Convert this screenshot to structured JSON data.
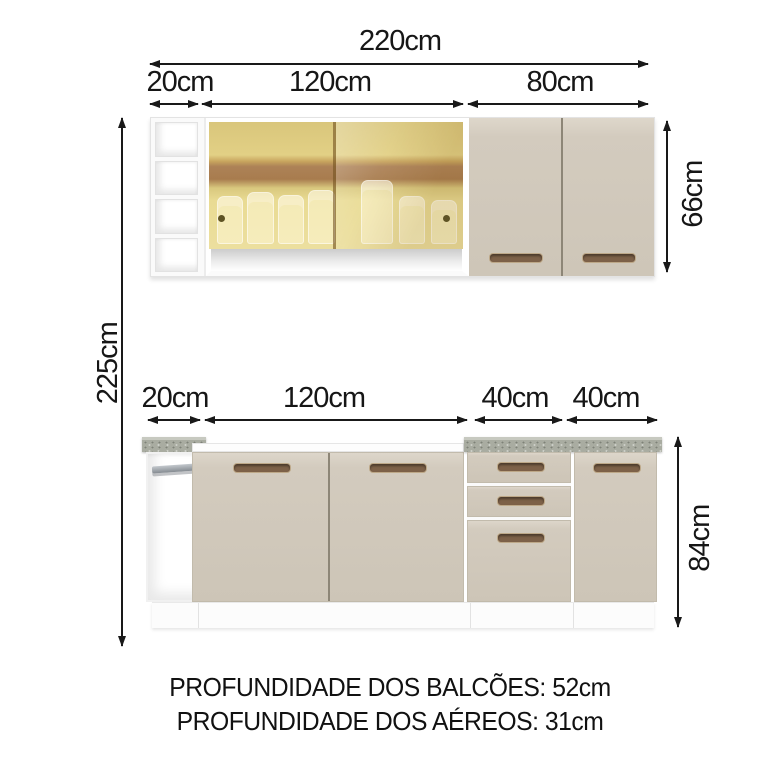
{
  "diagram": {
    "overall": {
      "width": "220cm",
      "height": "225cm"
    },
    "upper_cabinets": {
      "sections": [
        "20cm",
        "120cm",
        "80cm"
      ],
      "height": "66cm"
    },
    "lower_cabinets": {
      "sections": [
        "20cm",
        "120cm",
        "40cm",
        "40cm"
      ],
      "height": "84cm"
    },
    "notes": {
      "balcoes_depth": "PROFUNDIDADE DOS BALCÕES: 52cm",
      "aereos_depth": "PROFUNDIDADE DOS AÉREOS: 31cm"
    },
    "colors": {
      "dimension_text": "#1a1a1a",
      "door_cream": "#d3cbbe",
      "handle_brown": "#7d6148",
      "countertop_gray": "#a9aca1",
      "glass_gold": "#e2d085",
      "glass_shelf_band": "#a87c4e",
      "cabinet_white": "#ffffff"
    }
  }
}
